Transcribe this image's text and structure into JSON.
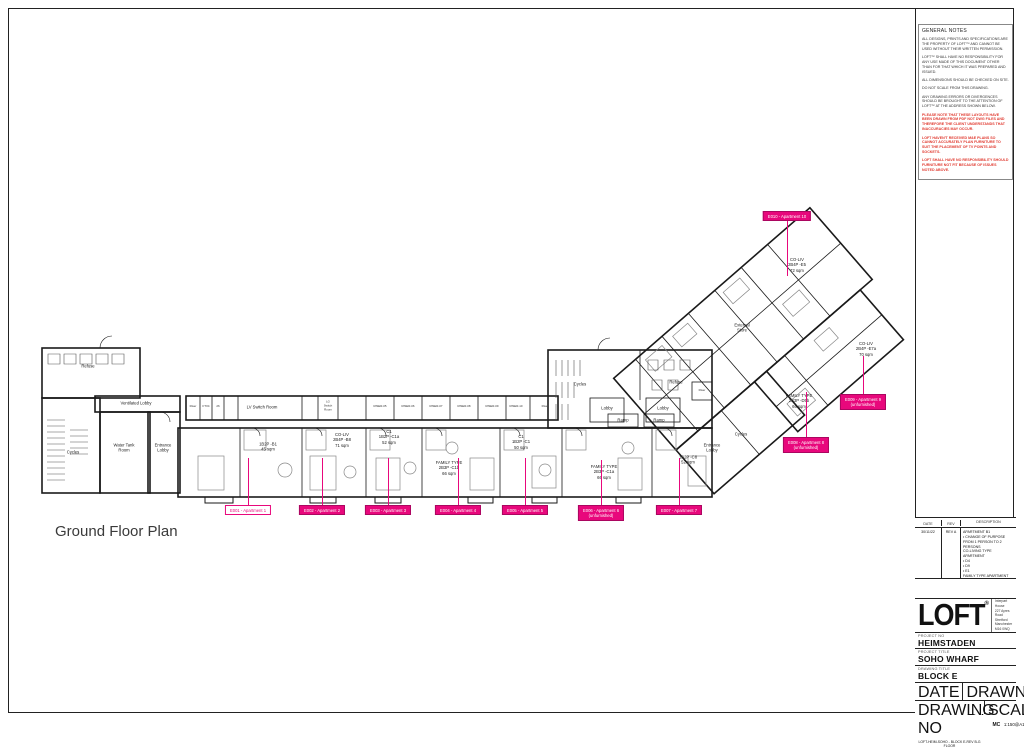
{
  "sheet": {
    "plan_title": "Ground Floor Plan",
    "accent_color": "#e8087c",
    "warning_color": "#e0392f"
  },
  "notes": {
    "title": "GENERAL NOTES",
    "paragraphs": [
      "ALL DESIGNS, PRINTS AND SPECIFICATIONS ARE THE PROPERTY OF LOFT™ AND CANNOT BE USED WITHOUT THEIR WRITTEN PERMISSION.",
      "LOFT™ SHALL HAVE NO RESPONSIBILITY FOR ANY USE MADE OF THIS DOCUMENT OTHER THAN FOR THAT WHICH IT WAS PREPARED AND ISSUED.",
      "ALL DIMENSIONS SHOULD BE CHECKED ON SITE.",
      "DO NOT SCALE FROM THIS DRAWING.",
      "ANY DRAWING ERRORS OR DIVERGENCES SHOULD BE BROUGHT TO THE ATTENTION OF LOFT™ AT THE ADDRESS SHOWN BELOW."
    ],
    "warning_lines": [
      "PLEASE NOTE THAT THESE LAYOUTS HAVE BEEN DRAWN FROM PDF NOT DWG FILES AND THEREFORE THE CLIENT UNDERSTANDS THAT INACCURACIES MAY OCCUR.",
      "LOFT HAVEN'T RECEIVED M&E PLANS SO CANNOT ACCURATELY PLAN FURNITURE TO SUIT THE PLACEMENT OF TV POINTS AND SOCKETS.",
      "LOFT SHALL HAVE NO RESPONSIBILITY SHOULD FURNITURE NOT FIT BECAUSE OF ISSUES NOTED ABOVE."
    ]
  },
  "revision_table": {
    "headers": [
      "DATE",
      "REV",
      "DESCRIPTION"
    ],
    "rows": [
      {
        "date": "30/11/22",
        "rev": "REV A",
        "description": "APARTMENT B1\n• CHANGE OF PURPOSE FROM 1 PERSON TO 2 PERSONS\nCO-LIVING TYPE APARTMENT\n• D4\n• D9\n• E1\nFAMILY TYPE APARTMENT\n• D5"
      }
    ]
  },
  "title_block": {
    "company": "LOFT",
    "registered": "®",
    "address": "Interpart House\n227 Ayres Road\nStretford\nManchester\nM16 0WQ",
    "project_no_label": "PROJECT NO",
    "project_no": "HEIMSTADEN",
    "project_title_label": "PROJECT TITLE",
    "project_title": "SOHO WHARF",
    "drawing_title_label": "DRAWING TITLE",
    "drawing_title": "BLOCK E",
    "date_label": "DATE",
    "date": "30/11/2022",
    "drawn_by_label": "DRAWN BY",
    "drawn_by": "MC",
    "drawing_no_label": "DRAWING NO",
    "drawing_no": "LOFT-HEIM-SOHO - BLOCK E-REV B-G FLOOR",
    "scale_label": "SCALE",
    "scale": "1:150@A1"
  },
  "plan": {
    "rooms": [
      "Refuse",
      "Ventilated Lobby",
      "Cycles",
      "Water Tank\nRoom",
      "Entrance\nLobby",
      "Cycles",
      "Refuse",
      "Lobby",
      "Lobby",
      "Ramp",
      "Ramp",
      "Riser",
      "Entrance\nLobby",
      "External\nStore",
      "Cycles"
    ],
    "top_strip": [
      "Riser",
      "FTX4",
      "26",
      "LV Switch Room",
      "LG\nSwitch\nRoom",
      "RISER-05",
      "RISER-06",
      "RISER-07",
      "RISER-08",
      "RISER-09",
      "RISER-10",
      "Riser"
    ],
    "units": [
      "1B2P -B1\n45 sqm",
      "CO-LIV\n2B4P -B8\n71 sqm",
      "C1\n1B2P -C1a\n52 sqm",
      "FAMILY TYPE\n2B3P -C1b\n66 sqm",
      "C1\n1B2P -C1\n50 sqm",
      "FAMILY TYPE\n2B3P -C1a\n66 sqm",
      "1B2P -C8\n52 sqm",
      "CO-LIV\n2B4P -E5\n72 sqm",
      "CO-LIV\n2B4P -E7a\n70 sqm",
      "FAMILY TYPE\n2B3P -D5b\n66 sqm"
    ],
    "tags": [
      "E010 - Apartment 10",
      "E001 - Apartment 1",
      "E002 - Apartment 2",
      "E003 - Apartment 3",
      "E004 - Apartment 4",
      "E005 - Apartment 5",
      "E006 - Apartment 6\n(unfurnished)",
      "E007 - Apartment 7",
      "E008 - Apartment 8\n(unfurnished)",
      "E009 - Apartment 9\n(unfurnished)"
    ]
  }
}
